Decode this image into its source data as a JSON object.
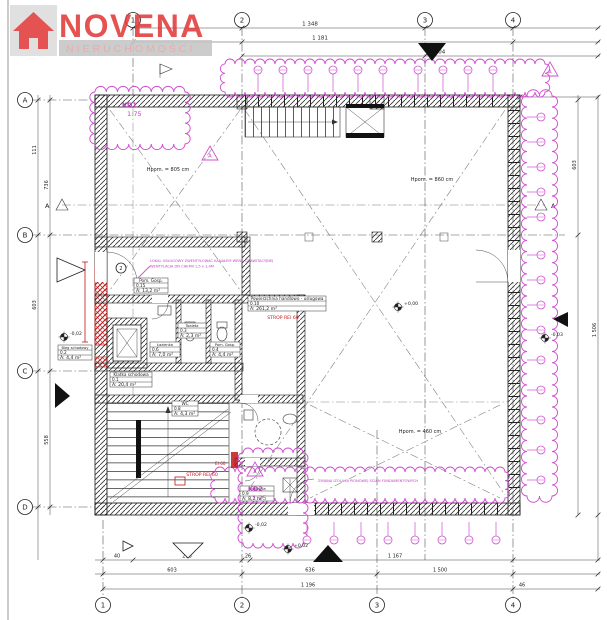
{
  "logo": {
    "brand": "NOVENA",
    "tagline": "NIERUCHOMOŚCI"
  },
  "colors": {
    "magenta": "#cf4fcf",
    "red": "#c01818",
    "logo_red": "#e23b3b"
  },
  "grid": {
    "top": [
      "1",
      "2",
      "3",
      "4"
    ],
    "bottom": [
      "1",
      "2",
      "3",
      "4"
    ],
    "left": [
      "A",
      "B",
      "C",
      "D"
    ],
    "section": "A",
    "revision_triangle": "A"
  },
  "dimensions": {
    "top": [
      "1 348",
      "1 181",
      "904"
    ],
    "bottom1": [
      "40",
      "298",
      "26",
      "1 167"
    ],
    "bottom2": [
      "603",
      "636",
      "1 500"
    ],
    "bottom3": [
      "1 196",
      "46"
    ],
    "left": [
      "111",
      "736",
      "603",
      "558"
    ],
    "right": [
      "603",
      "1 506"
    ]
  },
  "levels": {
    "plus_zero": "+0,00",
    "minus_a": "-0,02",
    "minus_b": "-0,02",
    "plus_b": "+0,02",
    "minus_c": "-0,03"
  },
  "rooms": [
    {
      "name": "Powierzchnia handlowo - usługowa",
      "no": "0.10",
      "area": "A: 261,2 m²"
    },
    {
      "name": "Klatka schodowa",
      "no": "0.1",
      "area": "A: 20,4 m²"
    },
    {
      "name": "Bieg schodowy",
      "no": "0.2",
      "area": "A: 4,4 m²"
    },
    {
      "name": "Pom. Gosp.",
      "no": "0.15",
      "area": "A: 13,2 m²"
    },
    {
      "name": "Pom. Gosp.",
      "no": "0.4",
      "area": "A: 4,4 m²"
    },
    {
      "name": "Łazienka",
      "no": "0.6",
      "area": "A: 7,0 m²"
    },
    {
      "name": "Toaleta",
      "no": "0.3",
      "area": "A: 2,3 m²"
    },
    {
      "name": "WC",
      "no": "0.8",
      "area": "A: 4,3 m²"
    },
    {
      "name": "Kotłownia",
      "no": "0.9",
      "area": "A: 8,2 m²"
    }
  ],
  "annotations": {
    "kd1": "KD1",
    "kd1_scale": "1:75",
    "kd2": "KD2",
    "kd2_scale": "1:25",
    "note_top_l1": "LOKAL USŁUGOWY ZWENTYLOWAĆ KANAŁEM WENT. GRAWITACYJNEJ",
    "note_top_l2": "WENTYLACJA DN CHEMII 1,5 x 1,4M",
    "note_bottom": "ZMIANA IZOLACJI PIONOWEJ ŚCIAN FUNDAMENTOWYCH",
    "strop1": "STROP REI 60",
    "strop2": "STROP REI 60",
    "ei": "EI 60",
    "hpom1": "Hpom. = 805 cm",
    "hpom2": "Hpom. = 860 cm",
    "hpom3": "Hpom. = 460 cm",
    "door_bubble": "2"
  }
}
